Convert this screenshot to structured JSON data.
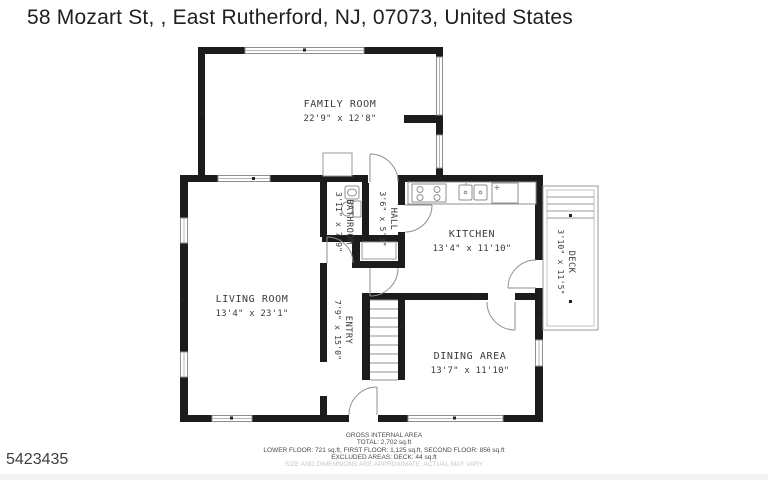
{
  "header": {
    "address": "58 Mozart St, , East Rutherford, NJ, 07073, United States"
  },
  "plan_id": "5423435",
  "rooms": {
    "family_room": {
      "name": "FAMILY ROOM",
      "dims": "22'9\" x 12'8\""
    },
    "kitchen": {
      "name": "KITCHEN",
      "dims": "13'4\" x 11'10\""
    },
    "living_room": {
      "name": "LIVING ROOM",
      "dims": "13'4\" x 23'1\""
    },
    "dining_area": {
      "name": "DINING AREA",
      "dims": "13'7\" x 11'10\""
    },
    "bathroom": {
      "name": "BATHROOM",
      "dims": "3'11\" x 7'9\""
    },
    "hall": {
      "name": "HALL",
      "dims": "3'6\" x 5'3\""
    },
    "entry": {
      "name": "ENTRY",
      "dims": "7'9\" x 15'0\""
    },
    "deck": {
      "name": "DECK",
      "dims": "3'10\" x 11'5\""
    }
  },
  "footer": {
    "heading": "GROSS INTERNAL AREA",
    "total": "TOTAL: 2,702 sq.ft",
    "floors": "LOWER FLOOR: 721 sq.ft, FIRST FLOOR: 1,125 sq.ft, SECOND FLOOR: 856 sq.ft",
    "excluded": "EXCLUDED AREAS: DECK: 44 sq.ft",
    "disclaimer": "SIZE AND DIMENSIONS ARE APPROXIMATE, ACTUAL MAY VARY"
  },
  "colors": {
    "wall": "#1c1c1c",
    "thin_line": "#8f8f8f",
    "label_text": "#3a3a3a",
    "disclaimer_text": "#c6c6c6"
  }
}
